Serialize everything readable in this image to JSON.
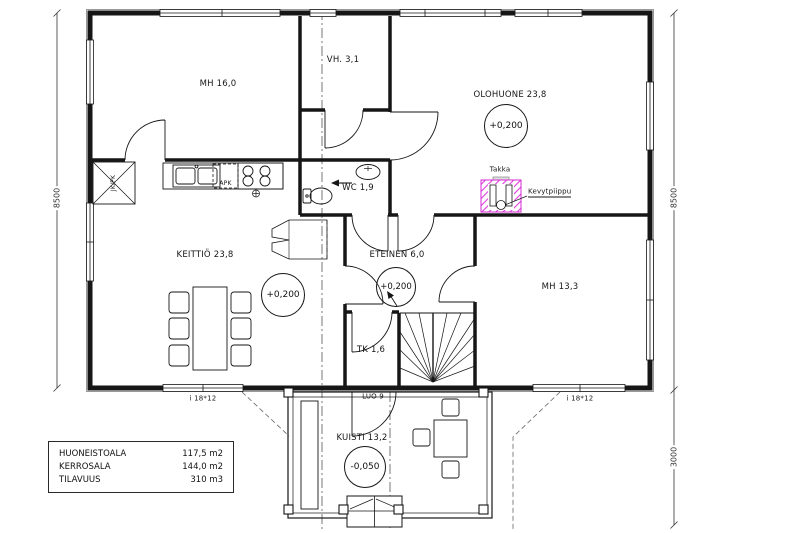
{
  "rooms": {
    "mh16": "MH 16,0",
    "vh": "VH. 3,1",
    "olohuone": "OLOHUONE 23,8",
    "keittio": "KEITTIÖ 23,8",
    "wc": "WC 1,9",
    "eteinen": "ETEINEN 6,0",
    "mh13": "MH 13,3",
    "tk": "TK 1,6",
    "kuisti": "KUISTI 13,2"
  },
  "levels": {
    "olohuone": "+0,200",
    "keittio": "+0,200",
    "eteinen": "+0,200",
    "kuisti": "-0,050"
  },
  "doors": {
    "luo": "LUO 9"
  },
  "fixtures": {
    "takka": "Takka",
    "kevytpiippu": "Kevytpiippu",
    "apk": "APK",
    "jk_pk": "JK/PK"
  },
  "window_labels": {
    "left": "i 18*12",
    "right": "i 18*12"
  },
  "dimensions": {
    "left": "8500",
    "right_upper": "8500",
    "right_lower": "3000"
  },
  "info_table": {
    "rows": [
      {
        "label": "HUONEISTOALA",
        "value": "117,5 m2"
      },
      {
        "label": "KERROSALA",
        "value": "144,0 m2"
      },
      {
        "label": "TILAVUUS",
        "value": "310 m3"
      }
    ]
  },
  "colors": {
    "line": "#161616",
    "chimney_hatch": "#e03ce0",
    "trim": "#999999"
  }
}
